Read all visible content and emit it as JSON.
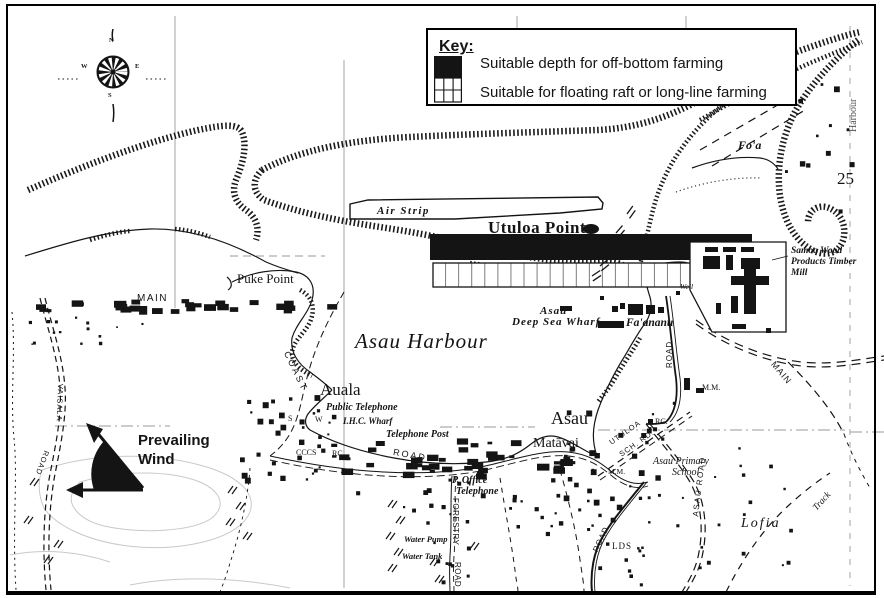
{
  "key": {
    "title": "Key:",
    "items": [
      {
        "symbol": "solid-black-square",
        "label": "Suitable depth for off-bottom farming"
      },
      {
        "symbol": "grid-square",
        "label": "Suitable for floating raft or long-line farming"
      }
    ]
  },
  "compass": {
    "n": "N",
    "e": "E",
    "s": "S",
    "w": "W"
  },
  "wind": {
    "line1": "Prevailing",
    "line2": "Wind"
  },
  "sheet_number": "25",
  "labels": {
    "foa": "Fo'a",
    "edge_vertical": "Harbour",
    "air_strip": "Air Strip",
    "utuloa_point": "Utuloa Point",
    "puke_point": "Puke Point",
    "main_left": "MAIN",
    "asau_harbour": "Asau Harbour",
    "auala": "Auala",
    "public_telephone": "Public Telephone",
    "ihc_wharf": "I.H.C. Wharf",
    "telephone_post": "Telephone Post",
    "cccs": "CCCS",
    "rc_west": "RC.",
    "s_mark": "S",
    "w_mark": "W",
    "coast": "COAST",
    "road_coast": "ROAD",
    "vaisala": "VAISALA",
    "vaisala_road": "ROAD",
    "asau_wharf_line1": "Asau",
    "asau_wharf_line2": "Deep Sea Wharf",
    "faananu": "Fa'ananu",
    "mill_line1": "Samoa Wood",
    "mill_line2": "Products Timber",
    "mill_line3": "Mill",
    "well": "Well",
    "road_east": "ROAD",
    "mm_east": "M.M.",
    "rc_east": "RC.",
    "utuloa_rd1": "UTULOA",
    "utuloa_rd2": "SCH. RD.",
    "asau_village": "Asau",
    "matavai": "Matāvai",
    "asau_primary_line1": "Asau Primary",
    "asau_primary_line2": "School",
    "mm_west": "M.M.",
    "p_office_line1": "P. Office",
    "p_office_line2": "Telephone",
    "forestry": "FORESTRY",
    "forestry_road": "ROAD",
    "water_pump": "Water Pump",
    "water_tank": "Water Tank",
    "lds": "LDS",
    "road_lds": "ROAD",
    "asau_road": "ASAU ROAD",
    "lofia": "Lofia",
    "track": "Track",
    "main_right": "MAIN"
  },
  "colors": {
    "ink": "#141414",
    "paper": "#ffffff",
    "graticule": "#9a9a9a"
  }
}
